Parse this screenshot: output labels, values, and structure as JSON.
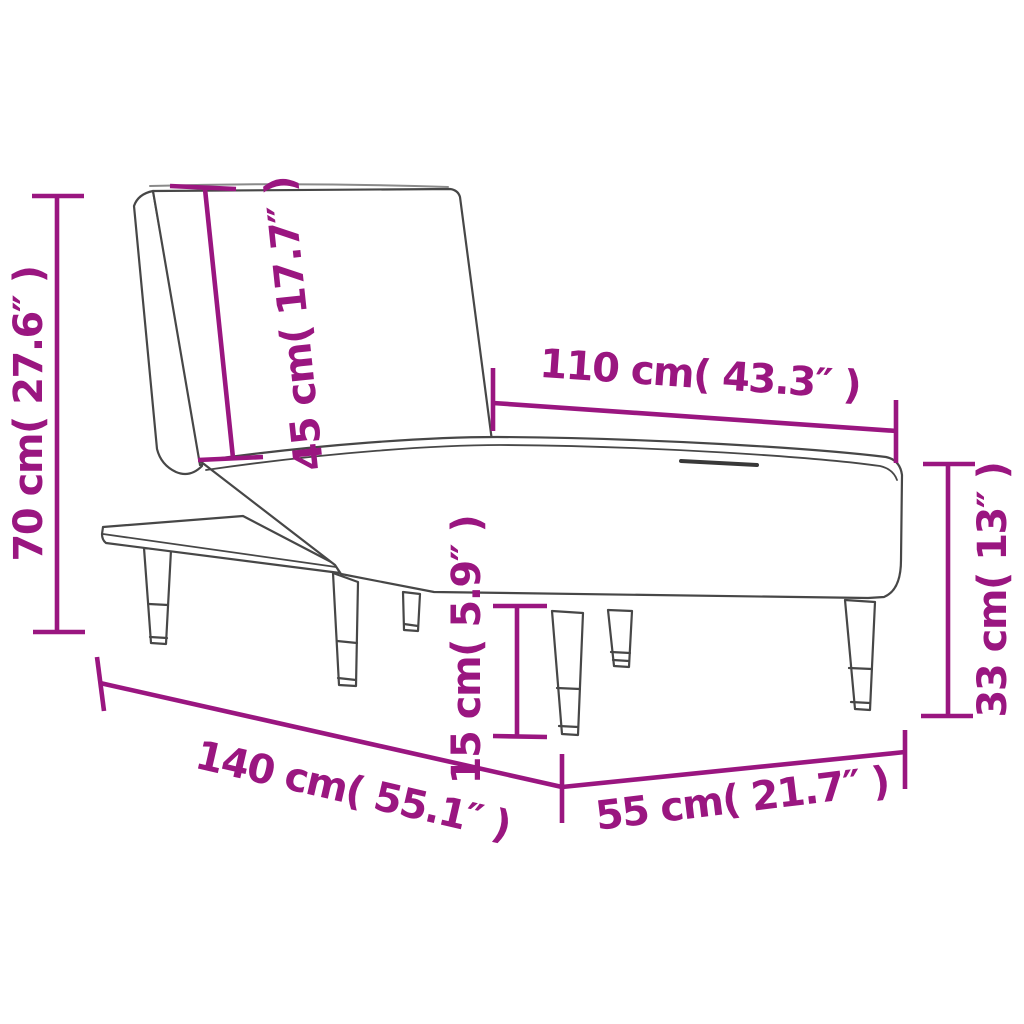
{
  "diagram": {
    "type": "product-dimension-diagram",
    "subject": "chaise longue line drawing with tapered legs and side shelf, three-quarter perspective view",
    "colors": {
      "dimension": "#9A1680",
      "outline": "#474747",
      "edge_highlight": "#8a8a8a",
      "background": "#ffffff"
    },
    "dimensions": [
      {
        "id": "total-height",
        "label": "70 cm( 27.6″ )",
        "cm": 70,
        "inches": 27.6,
        "orientation": "vertical-left"
      },
      {
        "id": "backrest-length",
        "label": "45 cm( 17.7″ )",
        "cm": 45,
        "inches": 17.7,
        "orientation": "along-backrest"
      },
      {
        "id": "seat-length",
        "label": "110 cm( 43.3″ )",
        "cm": 110,
        "inches": 43.3,
        "orientation": "along-seat-top"
      },
      {
        "id": "seat-height",
        "label": "33 cm( 13″ )",
        "cm": 33,
        "inches": 13,
        "orientation": "vertical-right"
      },
      {
        "id": "leg-height",
        "label": "15 cm( 5.9″ )",
        "cm": 15,
        "inches": 5.9,
        "orientation": "vertical-middle"
      },
      {
        "id": "total-length",
        "label": "140 cm( 55.1″ )",
        "cm": 140,
        "inches": 55.1,
        "orientation": "diagonal-bottom-left"
      },
      {
        "id": "total-depth",
        "label": "55 cm( 21.7″ )",
        "cm": 55,
        "inches": 21.7,
        "orientation": "diagonal-bottom-right"
      }
    ]
  }
}
